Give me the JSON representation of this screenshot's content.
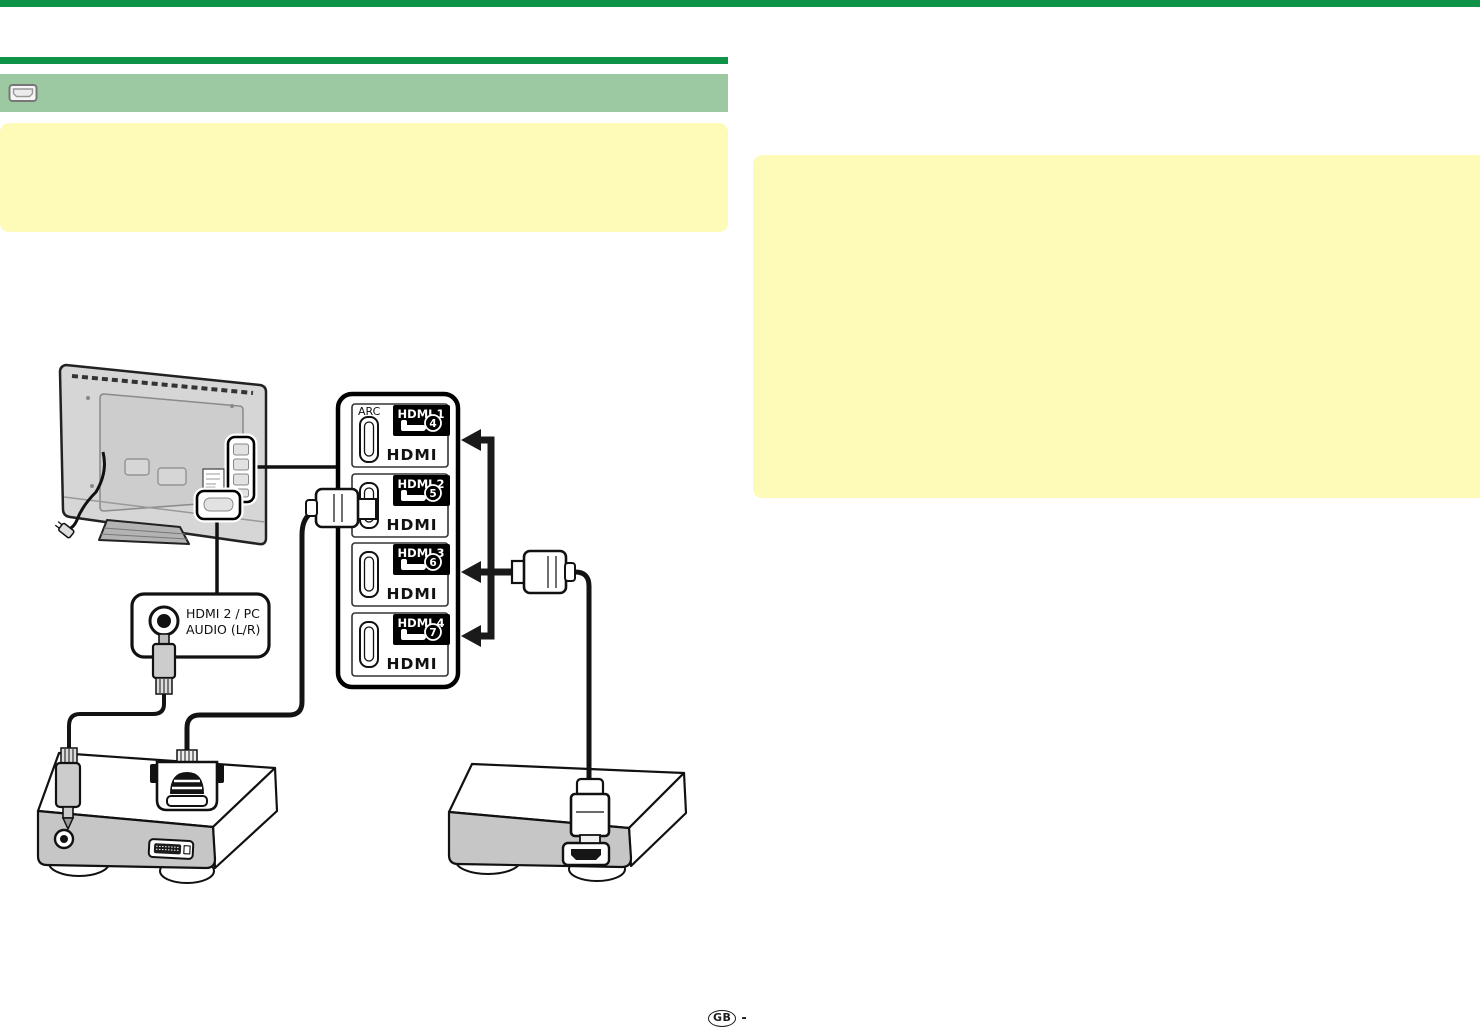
{
  "colors": {
    "top_bar_green": "#0e9349",
    "divider_green": "#0e9349",
    "section_bar_green": "#9cc9a2",
    "note_yellow": "#fdfbb7",
    "ink": "#111111"
  },
  "section_header": {
    "icon": "hdmi-connector-icon"
  },
  "connection_panel": {
    "ports": [
      {
        "label": "HDMI 1",
        "jack_number": "4",
        "tag": "ARC",
        "logo": "HDMI"
      },
      {
        "label": "HDMI 2",
        "jack_number": "5",
        "logo": "HDMI"
      },
      {
        "label": "HDMI 3",
        "jack_number": "6",
        "logo": "HDMI"
      },
      {
        "label": "HDMI 4",
        "jack_number": "7",
        "logo": "HDMI"
      }
    ]
  },
  "audio_terminal": {
    "label_line1": "HDMI 2 / PC",
    "label_line2": "AUDIO (L/R)"
  },
  "footer": {
    "region_code": "GB",
    "separator": "-"
  }
}
